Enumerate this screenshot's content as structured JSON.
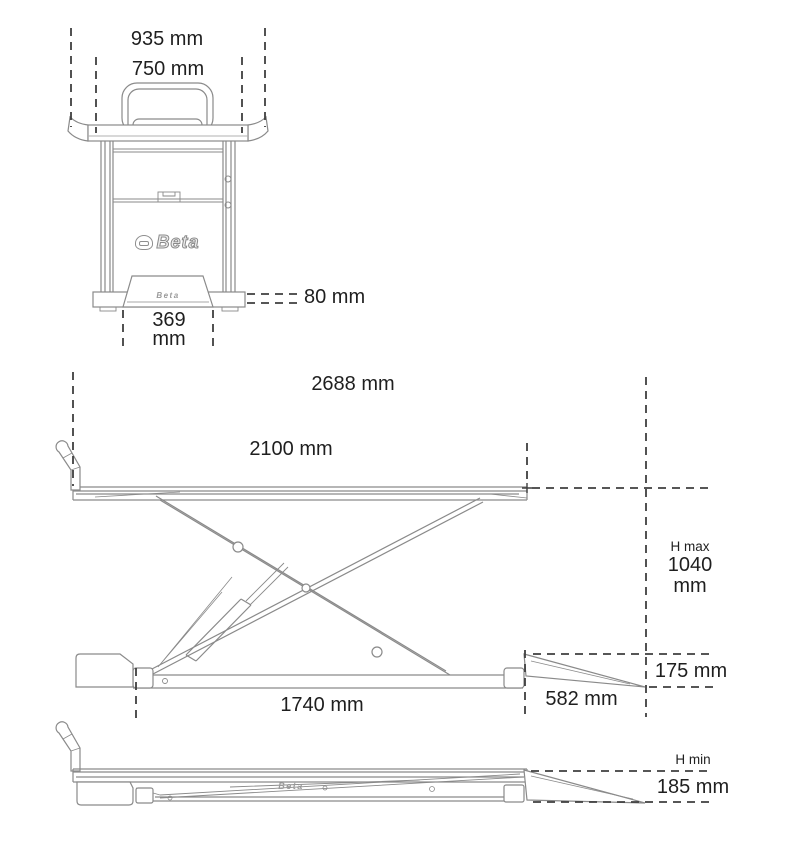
{
  "drawing": {
    "brand": "Beta",
    "colors": {
      "outline": "#8a8a8a",
      "dimension_line": "#3f3f3f",
      "text": "#1f1f1f",
      "background": "#ffffff"
    },
    "views": {
      "front": {
        "dim_overall_width": "935 mm",
        "dim_platform_width": "750 mm",
        "dim_base_height": "80 mm",
        "dim_ramp_width_value": "369",
        "dim_ramp_width_unit": "mm"
      },
      "side_raised": {
        "dim_overall_length": "2688 mm",
        "dim_platform_length": "2100 mm",
        "dim_height_max_label": "H max",
        "dim_height_max_value": "1040",
        "dim_height_max_unit": "mm",
        "dim_ramp_height": "175 mm",
        "dim_ramp_length": "582 mm",
        "dim_base_length": "1740 mm"
      },
      "side_lowered": {
        "dim_height_min_label": "H min",
        "dim_height_min_value": "185 mm"
      }
    }
  }
}
